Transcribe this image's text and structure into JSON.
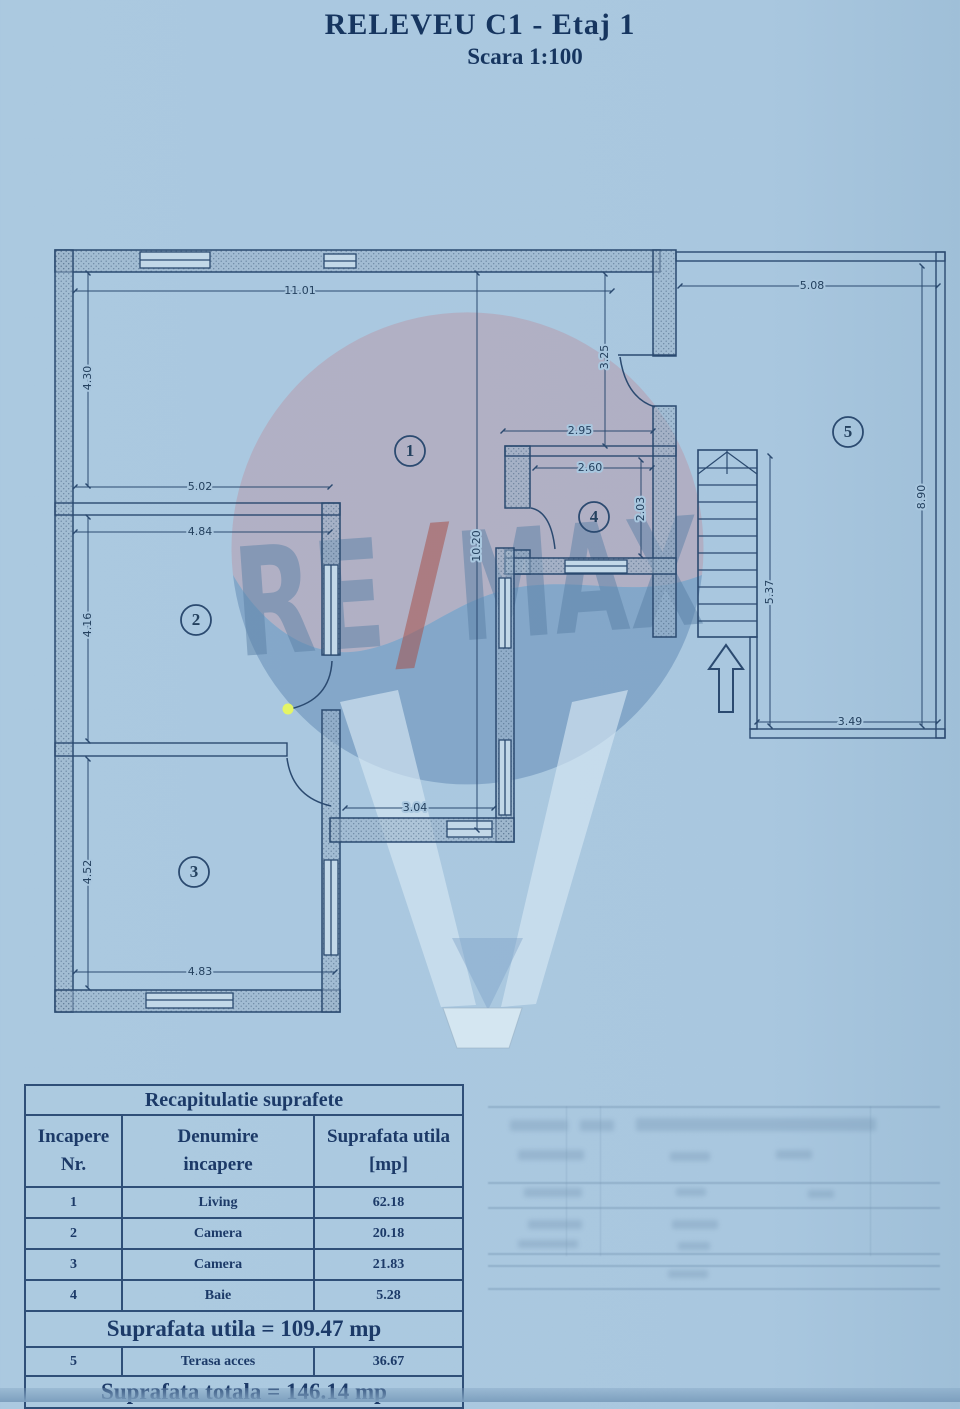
{
  "page": {
    "title": "RELEVEU C1 - Etaj 1",
    "subtitle": "Scara 1:100"
  },
  "plan": {
    "room_labels": [
      "1",
      "2",
      "3",
      "4",
      "5"
    ],
    "dimensions": [
      {
        "label": "11.01"
      },
      {
        "label": "5.08"
      },
      {
        "label": "4.30"
      },
      {
        "label": "3.25"
      },
      {
        "label": "2.95"
      },
      {
        "label": "2.60"
      },
      {
        "label": "2.03"
      },
      {
        "label": "5.02"
      },
      {
        "label": "4.84"
      },
      {
        "label": "4.16"
      },
      {
        "label": "10.20"
      },
      {
        "label": "3.04"
      },
      {
        "label": "4.52"
      },
      {
        "label": "4.83"
      },
      {
        "label": "5.37"
      },
      {
        "label": "8.90"
      },
      {
        "label": "3.49"
      }
    ],
    "watermark": {
      "left": "RE",
      "slash": "/",
      "right": "MAX"
    }
  },
  "table": {
    "title": "Recapitulatie suprafete",
    "columns": [
      {
        "line1": "Incapere",
        "line2": "Nr."
      },
      {
        "line1": "Denumire",
        "line2": "incapere"
      },
      {
        "line1": "Suprafata utila",
        "line2": "[mp]"
      }
    ],
    "rows": [
      {
        "nr": "1",
        "name": "Living",
        "area": "62.18"
      },
      {
        "nr": "2",
        "name": "Camera",
        "area": "20.18"
      },
      {
        "nr": "3",
        "name": "Camera",
        "area": "21.83"
      },
      {
        "nr": "4",
        "name": "Baie",
        "area": "5.28"
      }
    ],
    "subtotal": "Suprafata utila = 109.47 mp",
    "terrace_row": {
      "nr": "5",
      "name": "Terasa acces",
      "area": "36.67"
    },
    "total": "Suprafata totala = 146.14 mp"
  },
  "colors": {
    "background": "#a9c7df",
    "line": "#2b4a70",
    "text": "#1c3a68",
    "accent_dot": "#e4f566",
    "watermark_red": "#a5524b",
    "watermark_blue": "#5a82ab"
  }
}
